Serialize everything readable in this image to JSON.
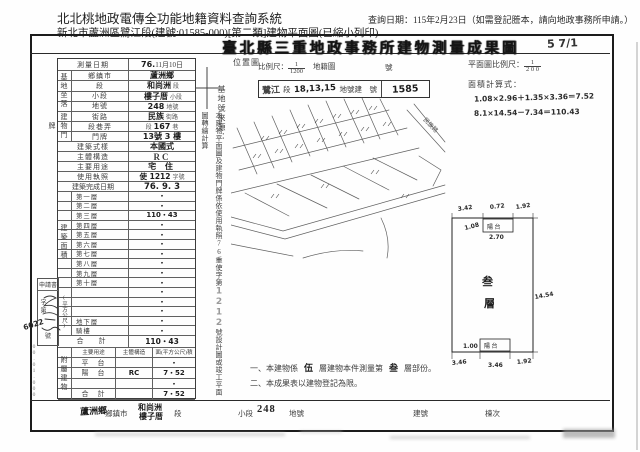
{
  "header": {
    "system_title": "北北桃地政電傳全功能地籍資料查詢系統",
    "query_date": "查詢日期：115年2月23日（如需登記謄本，請向地政事務所申請。）",
    "subtitle": "新北市蘆洲區鷺江段(建號:01585-000)[第二類]建物平面圖(已縮小列印)"
  },
  "document": {
    "title": "臺北縣三重地政事務所建物測量成果圖",
    "handwritten_mark": "5 7/1"
  },
  "survey_table": {
    "date_label": "測量日期",
    "date_value_hw": "76.",
    "date_value": "11月10日",
    "site_group_label": "基地坐落",
    "site_rows": [
      {
        "label": "鄉鎮市",
        "prefix": "",
        "value": "蘆洲鄉",
        "suffix": ""
      },
      {
        "label": "段",
        "prefix": "",
        "value": "和尚洲",
        "suffix": "段"
      },
      {
        "label": "小段",
        "prefix": "",
        "value": "樓子厝",
        "suffix": "小段"
      },
      {
        "label": "地號",
        "prefix": "",
        "value": "248",
        "suffix": "地號"
      }
    ],
    "door_group_label": "建物門牌",
    "door_rows": [
      {
        "label": "街路",
        "prefix": "",
        "value": "民族",
        "suffix": "街路"
      },
      {
        "label": "段巷弄",
        "prefix": "段",
        "value": "167",
        "suffix": "巷"
      },
      {
        "label": "門牌",
        "prefix": "",
        "value": "13號 3 樓",
        "suffix": ""
      }
    ],
    "style_label": "建築式樣",
    "style_value": "本國式",
    "structure_label": "主體構造",
    "structure_value": "RC",
    "use_label": "主要用途",
    "use_value": "宅 住",
    "license_label": "使用執照",
    "license_value": "使 1212",
    "license_suffix": "字號",
    "complete_label": "建築完成日期",
    "complete_value": "76. 9. 3",
    "area_group_label": "建築面積",
    "area_unit_label": "(平方公尺)",
    "floor_rows": [
      {
        "label": "第一層",
        "value": "・"
      },
      {
        "label": "第二層",
        "value": "・"
      },
      {
        "label": "第三層",
        "value": "110・43"
      },
      {
        "label": "第四層",
        "value": "・"
      },
      {
        "label": "第五層",
        "value": "・"
      },
      {
        "label": "第六層",
        "value": "・"
      },
      {
        "label": "第七層",
        "value": "・"
      },
      {
        "label": "第八層",
        "value": "・"
      },
      {
        "label": "第九層",
        "value": "・"
      },
      {
        "label": "第十層",
        "value": "・"
      },
      {
        "label": "",
        "value": "・"
      },
      {
        "label": "",
        "value": "・"
      },
      {
        "label": "",
        "value": "・"
      },
      {
        "label": "地下層",
        "value": "・"
      },
      {
        "label": "騎樓",
        "value": "・"
      }
    ],
    "total_label": "合　計",
    "total_value": "110・43"
  },
  "annex_table": {
    "group_label": "附屬建物",
    "col_use": "主要用途",
    "col_structure": "主體構造",
    "col_area": "面(平方公尺)積",
    "rows": [
      {
        "use": "平　台",
        "structure": "",
        "area": "・"
      },
      {
        "use": "陽　台",
        "structure": "RC",
        "area": "7・52"
      },
      {
        "use": "",
        "structure": "",
        "area": "・"
      },
      {
        "use": "合　計",
        "structure": "",
        "area": "7・52"
      }
    ]
  },
  "notes": {
    "n1_pre": "一、本建物係",
    "n1_hw1": "伍",
    "n1_mid": "層建物本件測量第",
    "n1_hw2": "叁",
    "n1_suf": "層部份。",
    "n2": "二、本成果表以建物登記為限。"
  },
  "location_map": {
    "label": "位置圖",
    "scale_label": "比例尺：",
    "scale_numerator": "1",
    "scale_denominator": "1200",
    "sheet_label": "地籍圖",
    "sheet_suffix": "號",
    "stamp_section_hw": "鷺江",
    "stamp_section_label": "段",
    "stamp_lots_hw": "18,13,15",
    "stamp_mid_label": "地號建　號",
    "stamp_building_no_hw": "1585",
    "road_label": "民族路"
  },
  "side_notes": {
    "base_source_label": "基地號來源：",
    "vertical_note_pre": "本建物平面圖及建物門牌係依使用執照76重使字第",
    "vertical_note_hw": "1212",
    "vertical_note_suf": "號設計圖或竣工平面圖轉繪計算"
  },
  "floor_plan": {
    "scale_label": "平面圖比例尺：",
    "scale_numerator": "1",
    "scale_denominator": "2 0 0",
    "calc_label": "面積計算式：",
    "calc_line1": "1.08×2.96＋1.35×3.36＝7.52",
    "calc_line2": "8.1×14.54－7.34＝110.43",
    "room_char1": "叁",
    "room_char2": "層",
    "balcony_top_label": "陽 台",
    "balcony_bottom_label": "陽 台",
    "dim_top_left": "3.42",
    "dim_top_mid": "0.72",
    "dim_top_right": "1.92",
    "dim_balcony_depth": "1.08",
    "dim_balcony_width": "2.70",
    "dim_right": "14.54",
    "dim_bottom_balcony": "1.00",
    "dim_bottom_1": "3.46",
    "dim_bottom_2": "3.46",
    "dim_bottom_3": "1.92"
  },
  "margin": {
    "application_label": "申請書",
    "no_prefix_label": "字第",
    "no_suffix_label": "號",
    "handwritten_no": "6022",
    "micro_label": "00.01.000"
  },
  "footer": {
    "township_hw": "蘆洲鄉",
    "township_label": "鄉鎮市",
    "section_hw1": "和尚洲",
    "section_hw2": "樓子厝",
    "section_label": "段",
    "subsection_label": "小段",
    "lot_no": "248",
    "lot_label": "地號",
    "building_label": "建號",
    "block_label": "棟次"
  }
}
